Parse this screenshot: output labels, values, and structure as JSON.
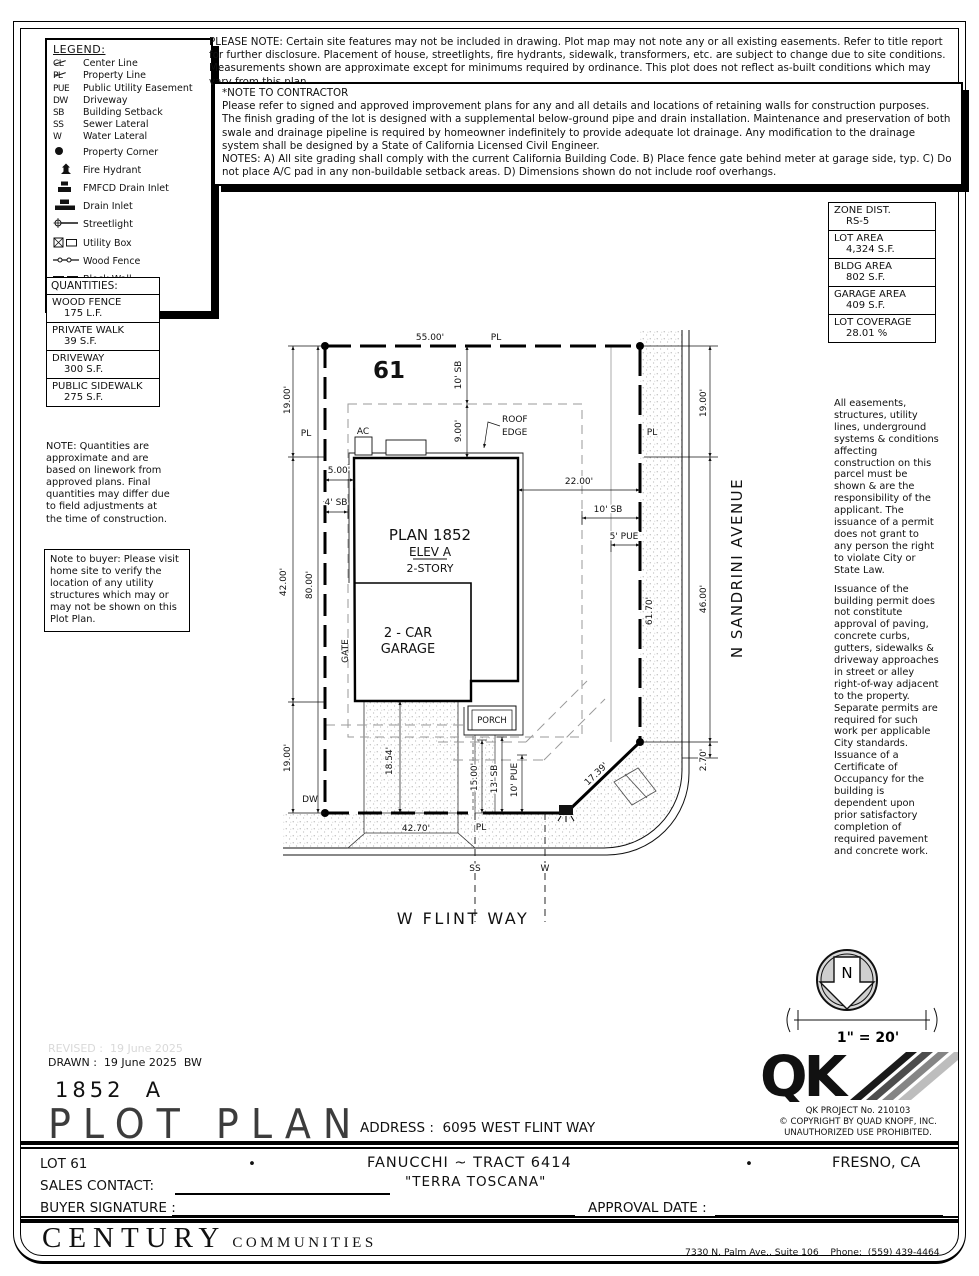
{
  "legend": {
    "title": "LEGEND:",
    "items": [
      {
        "sym": "CL",
        "label": "Center Line"
      },
      {
        "sym": "PL",
        "label": "Property Line"
      },
      {
        "sym": "PUE",
        "label": "Public Utility Easement"
      },
      {
        "sym": "DW",
        "label": "Driveway"
      },
      {
        "sym": "SB",
        "label": "Building Setback"
      },
      {
        "sym": "SS",
        "label": "Sewer Lateral"
      },
      {
        "sym": "W",
        "label": "Water Lateral"
      },
      {
        "label": "Property Corner"
      },
      {
        "label": "Fire Hydrant"
      },
      {
        "label": "FMFCD Drain Inlet"
      },
      {
        "label": "Drain Inlet"
      },
      {
        "label": "Streetlight"
      },
      {
        "label": "Utility Box"
      },
      {
        "label": "Wood Fence"
      },
      {
        "label": "Block Wall"
      },
      {
        "label": "Concrete"
      }
    ]
  },
  "please_note": "PLEASE NOTE:  Certain site features may not be included in drawing.  Plot map may not note any or all existing easements. Refer to title report for further disclosure.  Placement of house, streetlights, fire hydrants, sidewalk, transformers, etc. are subject to change due to site conditions.  Measurements shown are approximate except for minimums required by ordinance.  This plot does not reflect as-built conditions which may vary from this plan.",
  "contractor_note": {
    "title": "*NOTE TO CONTRACTOR",
    "p1": "Please refer to signed and approved improvement plans for any and all details and locations of retaining walls for construction purposes.",
    "p2": "The finish grading of the lot is designed with a supplemental below-ground pipe and drain installation.  Maintenance and preservation of both swale and drainage pipeline is required by homeowner indefinitely to provide adequate lot drainage.  Any modification to the drainage system shall be designed by a State of California Licensed Civil Engineer.",
    "p3": "NOTES:  A) All site grading shall comply with the current California Building Code.  B) Place fence gate behind meter at garage side, typ.  C) Do not place A/C pad in any non-buildable setback areas.  D) Dimensions shown do not include roof overhangs."
  },
  "zone_table": [
    {
      "label": "ZONE DIST.",
      "value": "RS-5"
    },
    {
      "label": "LOT AREA",
      "value": "4,324 S.F."
    },
    {
      "label": "BLDG AREA",
      "value": "802 S.F."
    },
    {
      "label": "GARAGE AREA",
      "value": "409 S.F."
    },
    {
      "label": "LOT COVERAGE",
      "value": "28.01 %"
    }
  ],
  "quantities": {
    "title": "QUANTITIES:",
    "rows": [
      {
        "name": "WOOD FENCE",
        "value": "175 L.F."
      },
      {
        "name": "PRIVATE WALK",
        "value": "39 S.F."
      },
      {
        "name": "DRIVEWAY",
        "value": "300 S.F."
      },
      {
        "name": "PUBLIC SIDEWALK",
        "value": "275 S.F."
      }
    ]
  },
  "quantities_note": "NOTE: Quantities are approximate and are based on linework from approved plans.  Final quantities may differ due to field adjustments at the time of construction.",
  "buyer_note": "Note to buyer: Please visit home site to verify the location of any utility structures which may or may not be shown on this Plot Plan.",
  "right_notes": {
    "p1": "All easements, structures, utility lines, underground systems & conditions affecting construction on this parcel must be shown & are the responsibility of the applicant. The issuance of a permit does not grant to any person the right to violate City or State Law.",
    "p2": "Issuance of the building permit does not constitute approval of paving, concrete curbs, gutters, sidewalks & driveway approaches in street or alley right-of-way adjacent to the property. Separate permits are required for such work per applicable City standards. Issuance of a Certificate of Occupancy for the building is dependent upon prior satisfactory completion of required pavement and concrete work."
  },
  "plan": {
    "labels": {
      "lot": "61",
      "plan": "PLAN 1852",
      "elev": "ELEV A",
      "story": "2-STORY",
      "car": "2 - CAR",
      "garage": "GARAGE",
      "porch": "PORCH",
      "roof_l1": "ROOF",
      "roof_l2": "EDGE",
      "ac": "AC",
      "gate": "GATE",
      "dw": "DW",
      "pl": "PL",
      "ss": "SS",
      "w": "W"
    },
    "dims": {
      "d55": "55.00'",
      "d19": "19.00'",
      "d42": "42.00'",
      "d80": "80.00'",
      "d9": "9.00'",
      "d10sb": "10' SB",
      "d5": "5.00'",
      "d4sb": "4' SB",
      "d22": "22.00'",
      "d5pue": "5' PUE",
      "d46": "46.00'",
      "d270": "2.70'",
      "d6170": "61.70'",
      "d1739": "17.39'",
      "d4270": "42.70'",
      "d1854": "18.54'",
      "d15": "15.00'",
      "d13sb": "13' SB",
      "d10pue": "10' PUE"
    },
    "streets": {
      "flint": "W FLINT WAY",
      "sandrini": "N SANDRINI AVENUE"
    }
  },
  "north": {
    "n": "N",
    "scale": "1\" = 20'"
  },
  "qk": {
    "logo": "QK",
    "project": "QK PROJECT No. 210103",
    "copyright": "©  COPYRIGHT BY QUAD KNOPF, INC.",
    "unauthorized": "UNAUTHORIZED USE PROHIBITED."
  },
  "titleblock": {
    "revised": "REVISED :  19 June 2025",
    "drawn": "DRAWN :  19 June 2025  BW",
    "plan_no": "1852  A",
    "title": "PLOT PLAN",
    "address": "ADDRESS :  6095 WEST FLINT WAY"
  },
  "footer": {
    "lot": "LOT 61",
    "bullet": "•",
    "tract": "FANUCCHI ~ TRACT 6414",
    "community": "\"TERRA TOSCANA\"",
    "city": "FRESNO, CA",
    "sales_label": "SALES CONTACT:",
    "buyer_label": "BUYER SIGNATURE :",
    "approval_label": "APPROVAL DATE :",
    "brand": "CENTURY",
    "brand2": "COMMUNITIES",
    "addr1": "7330 N. Palm Ave., Suite 106    Phone:  (559) 439-4464",
    "addr2": "Fresno, CA  93711"
  }
}
